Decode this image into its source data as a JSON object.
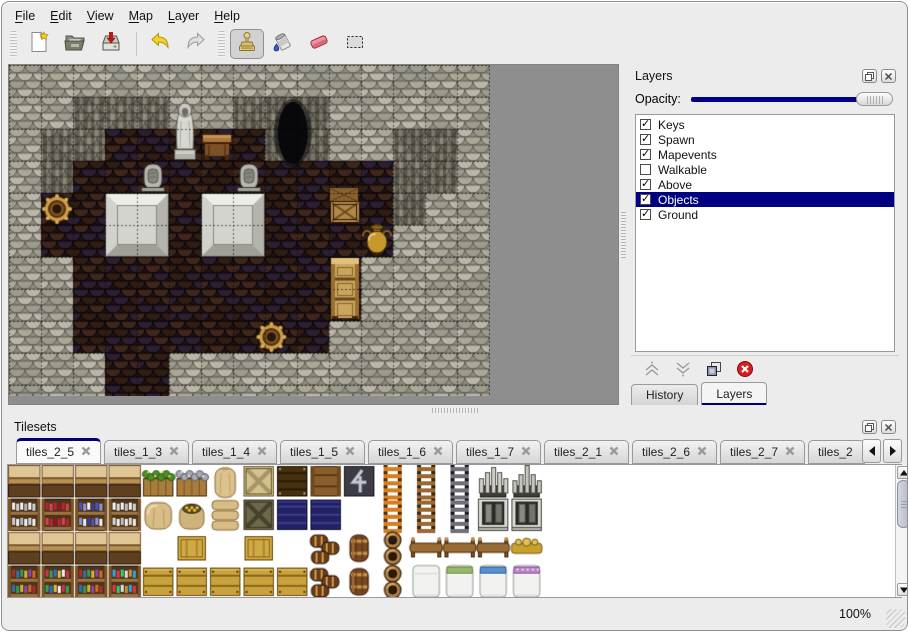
{
  "menu": {
    "items": [
      {
        "mnemonic": "F",
        "rest": "ile"
      },
      {
        "mnemonic": "E",
        "rest": "dit"
      },
      {
        "mnemonic": "V",
        "rest": "iew"
      },
      {
        "mnemonic": "M",
        "rest": "ap"
      },
      {
        "mnemonic": "L",
        "rest": "ayer"
      },
      {
        "mnemonic": "H",
        "rest": "elp"
      }
    ]
  },
  "toolbar": {
    "tools": [
      "new-map",
      "open-map",
      "save-map",
      "undo",
      "redo",
      "stamp-tool",
      "fill-tool",
      "eraser-tool",
      "select-tool"
    ],
    "active_tool": "stamp-tool"
  },
  "layers_panel": {
    "title": "Layers",
    "opacity_label": "Opacity:",
    "opacity_percent": 100,
    "layers": [
      {
        "label": "Keys",
        "checked": true,
        "selected": false
      },
      {
        "label": "Spawn",
        "checked": true,
        "selected": false
      },
      {
        "label": "Mapevents",
        "checked": true,
        "selected": false
      },
      {
        "label": "Walkable",
        "checked": false,
        "selected": false
      },
      {
        "label": "Above",
        "checked": true,
        "selected": false
      },
      {
        "label": "Objects",
        "checked": true,
        "selected": true
      },
      {
        "label": "Ground",
        "checked": true,
        "selected": false
      }
    ],
    "tabs": [
      {
        "label": "History",
        "active": false
      },
      {
        "label": "Layers",
        "active": true
      }
    ]
  },
  "tilesets_panel": {
    "title": "Tilesets",
    "tabs": [
      {
        "label": "tiles_2_5",
        "active": true,
        "truncated": false
      },
      {
        "label": "tiles_1_3",
        "active": false,
        "truncated": false
      },
      {
        "label": "tiles_1_4",
        "active": false,
        "truncated": false
      },
      {
        "label": "tiles_1_5",
        "active": false,
        "truncated": false
      },
      {
        "label": "tiles_1_6",
        "active": false,
        "truncated": false
      },
      {
        "label": "tiles_1_7",
        "active": false,
        "truncated": false
      },
      {
        "label": "tiles_2_1",
        "active": false,
        "truncated": false
      },
      {
        "label": "tiles_2_6",
        "active": false,
        "truncated": false
      },
      {
        "label": "tiles_2_7",
        "active": false,
        "truncated": false
      },
      {
        "label": "tiles_2",
        "active": false,
        "truncated": true
      }
    ]
  },
  "statusbar": {
    "zoom": "100%"
  },
  "glyphs": {
    "check": "✓"
  },
  "colors": {
    "accent_navy": "#00008b",
    "selection_navy": "#000080",
    "tab_underline": "#000074",
    "map_background": "#8e8e8e",
    "scrollbar_thumb": "#c2c8d4"
  },
  "map": {
    "tile_size": 32,
    "cols": 15,
    "rows": 11,
    "wall_palette": {
      "base": "#8f8c81",
      "a": "#aca898",
      "b": "#bab6a9",
      "c": "#9d9a8e",
      "line": "#5e5b52"
    },
    "floor_palette": {
      "base": "#1d1119",
      "a": "#3e261b",
      "b": "#301d13",
      "c": "#2b1f31",
      "line": "#0d0708"
    },
    "floor_spans": [
      [
        2,
        3,
        7
      ],
      [
        3,
        2,
        11
      ],
      [
        4,
        1,
        11
      ],
      [
        5,
        1,
        11
      ],
      [
        6,
        2,
        10
      ],
      [
        7,
        2,
        10
      ],
      [
        8,
        2,
        9
      ],
      [
        9,
        3,
        4
      ],
      [
        10,
        3,
        4
      ]
    ],
    "wall_faces": [
      [
        2,
        1
      ],
      [
        3,
        1
      ],
      [
        4,
        1
      ],
      [
        7,
        1
      ],
      [
        8,
        1
      ],
      [
        9,
        1
      ],
      [
        1,
        2
      ],
      [
        2,
        2
      ],
      [
        8,
        2
      ],
      [
        9,
        2
      ],
      [
        12,
        2
      ],
      [
        13,
        2
      ],
      [
        1,
        3
      ],
      [
        12,
        3
      ],
      [
        13,
        3
      ],
      [
        12,
        4
      ]
    ],
    "objects": [
      {
        "type": "platform",
        "col": 3,
        "row": 4
      },
      {
        "type": "platform",
        "col": 6,
        "row": 4
      },
      {
        "type": "statue",
        "col": 5,
        "row": 1
      },
      {
        "type": "desk",
        "col": 6,
        "row": 2
      },
      {
        "type": "cave",
        "col": 8.4,
        "row": 1
      },
      {
        "type": "grave",
        "col": 4,
        "row": 3
      },
      {
        "type": "grave",
        "col": 7,
        "row": 3
      },
      {
        "type": "barrel",
        "col": 1,
        "row": 4
      },
      {
        "type": "crates",
        "col": 10,
        "row": 4
      },
      {
        "type": "jug",
        "col": 11,
        "row": 5
      },
      {
        "type": "cabinet",
        "col": 10,
        "row": 6
      },
      {
        "type": "barrel",
        "col": 7.7,
        "row": 8
      }
    ]
  },
  "tileset_view": {
    "pitch": 33,
    "tile": 32,
    "grid": [
      [
        "shelfA_top",
        "shelfA_top",
        "shelfA_top",
        "shelfA_top",
        "crate_plants",
        "crate_stones",
        "sack_top",
        "crate_x_light",
        "crate_dark",
        "crate_face",
        "sign_z",
        "ladder_o",
        "ladder_b",
        "ladder_k",
        "arch_a_top",
        "arch_b_top"
      ],
      [
        "shelf_dishes",
        "shelf_redb",
        "shelf_blueb",
        "shelf_jugs",
        "sack_big",
        "sack_open",
        "sack_pile",
        "crate_x_dark",
        "crate_navy",
        "crate_navy",
        "blank",
        "ladder_o",
        "ladder_b",
        "ladder_k",
        "arch_a_bot",
        "arch_b_bot"
      ],
      [
        "shelfA_top",
        "shelfA_top",
        "shelfA_top",
        "shelfA_top",
        "blank",
        "crate_top",
        "blank",
        "crate_top",
        "blank",
        "barrels3",
        "barrel",
        "pots2",
        "bedhead",
        "bedhead",
        "bedhead",
        "bedhead_gold"
      ],
      [
        "shelf_books",
        "shelf_potions",
        "shelf_books",
        "shelf_cans",
        "crate_front",
        "crate_front",
        "crate_front",
        "crate_front",
        "crate_front",
        "barrels3",
        "barrel",
        "pots2",
        "bed_white",
        "bed_green",
        "bed_blue",
        "bed_purple"
      ]
    ]
  }
}
